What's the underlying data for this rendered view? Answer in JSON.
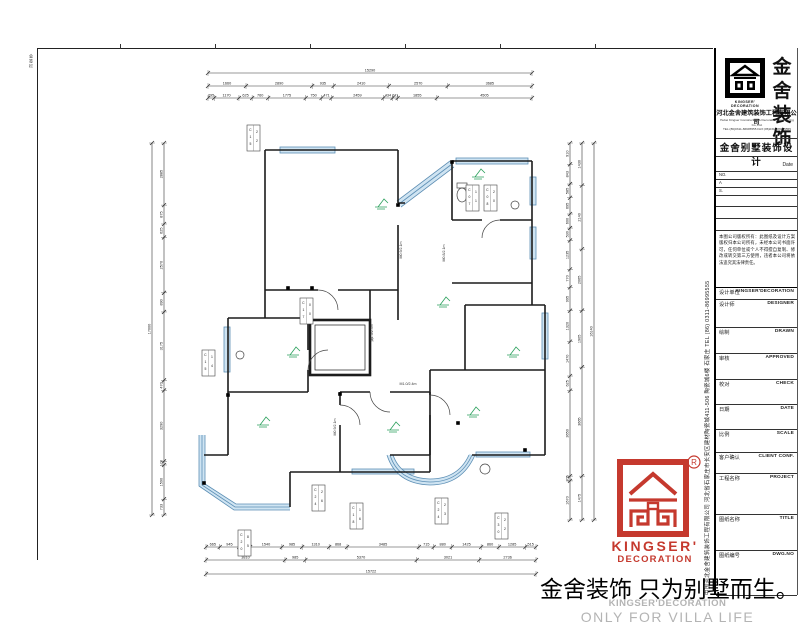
{
  "colors": {
    "brand_red": "#c5392e",
    "window_fill": "#cfe4f2",
    "window_stroke": "#5d8fb5",
    "annotation_green": "#2ba05c",
    "wall": "#1c1c1c",
    "dim": "#333333",
    "footer_gray": "#b4b4b4"
  },
  "sheet": {
    "signoff": "会签栏"
  },
  "title_block": {
    "logo": {
      "cn": "金舍\n装饰",
      "en1": "KINGSER'",
      "en2": "DECORATION"
    },
    "company_cn": "河北金舍建筑装饰工程有限公司",
    "company_en1": "Hebei Kingser Construction & Decoration Engineering Co.,Ltd.",
    "company_en2": "TEL:(86)0311-86995555  FAX:(86)0311-86995555",
    "product_title": "金舍别墅装饰设计",
    "date_label": "Date",
    "rev_labels": [
      "NO.",
      "A",
      "S."
    ],
    "notice": "本图公司版权所有：此图纸及设计方案版权归本公司所有，未经本公司书面许可，任何单位或个人不得擅自复制、修改或转交第三方使用，违者本公司将依法追究其法律责任。",
    "fields": [
      {
        "cn": "设计单位",
        "en": "KINGSER'DECORATION"
      },
      {
        "cn": "设计师",
        "en": "DESIGNER"
      },
      {
        "cn": "绘制",
        "en": "DRAWN"
      },
      {
        "cn": "审核",
        "en": "APPROVED"
      },
      {
        "cn": "校对",
        "en": "CHECK"
      },
      {
        "cn": "日期",
        "en": "DATE"
      },
      {
        "cn": "比例",
        "en": "SCALE"
      },
      {
        "cn": "客户确认",
        "en": "CLIENT CONF."
      },
      {
        "cn": "工程名称",
        "en": "PROJECT"
      },
      {
        "cn": "图纸名称",
        "en": "TITLE"
      },
      {
        "cn": "图纸编号",
        "en": "DWG.NO"
      }
    ],
    "vertical_address": "中国河北金舍建筑装饰工程有限公司  河北省石家庄市长安区建材陶瓷城411-506  陶瓷城6楼  石家庄  TEL (86) 0311-86995555"
  },
  "footer": {
    "slogan_cn": "金舍装饰 只为别墅而生。",
    "brand_en": "KINGSER'DECORATION",
    "slogan_en": "ONLY FOR VILLA LIFE",
    "seal_line1": "KINGSER'",
    "seal_line2": "DECORATION",
    "registered": "R"
  },
  "plan": {
    "dimensions": {
      "top_total": [
        "15290"
      ],
      "top_row2": [
        "1660",
        "2890",
        "935",
        "2410",
        "2570",
        "3685"
      ],
      "top_row3": [
        "295",
        "1170",
        "625",
        "760",
        "1775",
        "750",
        "471",
        "2459",
        "434",
        "241",
        "1855",
        "4505"
      ],
      "bottom_row1": [
        "665",
        "945",
        "530",
        "1540",
        "985",
        "1310",
        "868",
        "3485",
        "715",
        "880",
        "1425",
        "860",
        "1285",
        "515"
      ],
      "bottom_row2": [
        "3810",
        "985",
        "5370",
        "3021",
        "2736"
      ],
      "bottom_total": [
        "15722"
      ],
      "left_total": [
        "17000"
      ],
      "left_row": [
        "2885",
        "875",
        "625",
        "2570",
        "890",
        "3175",
        "470",
        "3290",
        "170",
        "1590",
        "733"
      ],
      "right_row1": [
        "910",
        "843",
        "585",
        "695",
        "600",
        "530",
        "1235",
        "770",
        "995",
        "1320",
        "1470",
        "625",
        "3650",
        "205",
        "1670"
      ],
      "right_row2": [
        "1430",
        "2140",
        "2065",
        "1905",
        "3665",
        "1475"
      ],
      "right_total": [
        "16140"
      ]
    },
    "window_tags": [
      {
        "code": "C1522",
        "x": 107,
        "y": 70
      },
      {
        "code": "C0711",
        "x": 326,
        "y": 130
      },
      {
        "code": "C0820",
        "x": 344,
        "y": 130
      },
      {
        "code": "C1700",
        "x": 160,
        "y": 243
      },
      {
        "code": "C1514",
        "x": 62,
        "y": 295
      },
      {
        "code": "C2426",
        "x": 172,
        "y": 430
      },
      {
        "code": "C1816",
        "x": 210,
        "y": 448
      },
      {
        "code": "C2423",
        "x": 295,
        "y": 443
      },
      {
        "code": "C3022",
        "x": 355,
        "y": 458
      },
      {
        "code": "C2085",
        "x": 98,
        "y": 475
      }
    ],
    "door_labels": [
      {
        "text": "M0.9/2.1m",
        "x": 262,
        "y": 195,
        "rot": -90
      },
      {
        "text": "M0.8/2.1m",
        "x": 305,
        "y": 198,
        "rot": -90
      },
      {
        "text": "洞1.5/2.4m",
        "x": 233,
        "y": 278,
        "rot": -90
      },
      {
        "text": "M0.9/2.1m",
        "x": 196,
        "y": 372,
        "rot": -90
      },
      {
        "text": "M1.0/2.4m",
        "x": 268,
        "y": 330,
        "rot": 0
      }
    ],
    "green_markers": [
      {
        "x": 238,
        "y": 152
      },
      {
        "x": 335,
        "y": 122
      },
      {
        "x": 300,
        "y": 250
      },
      {
        "x": 150,
        "y": 300
      },
      {
        "x": 250,
        "y": 375
      },
      {
        "x": 330,
        "y": 360
      },
      {
        "x": 370,
        "y": 300
      },
      {
        "x": 120,
        "y": 370
      }
    ],
    "columns": [
      {
        "x": 148,
        "y": 233
      },
      {
        "x": 172,
        "y": 233
      },
      {
        "x": 258,
        "y": 150
      },
      {
        "x": 312,
        "y": 107
      },
      {
        "x": 385,
        "y": 395
      },
      {
        "x": 200,
        "y": 339
      },
      {
        "x": 88,
        "y": 340
      },
      {
        "x": 64,
        "y": 428
      },
      {
        "x": 318,
        "y": 368
      }
    ]
  }
}
